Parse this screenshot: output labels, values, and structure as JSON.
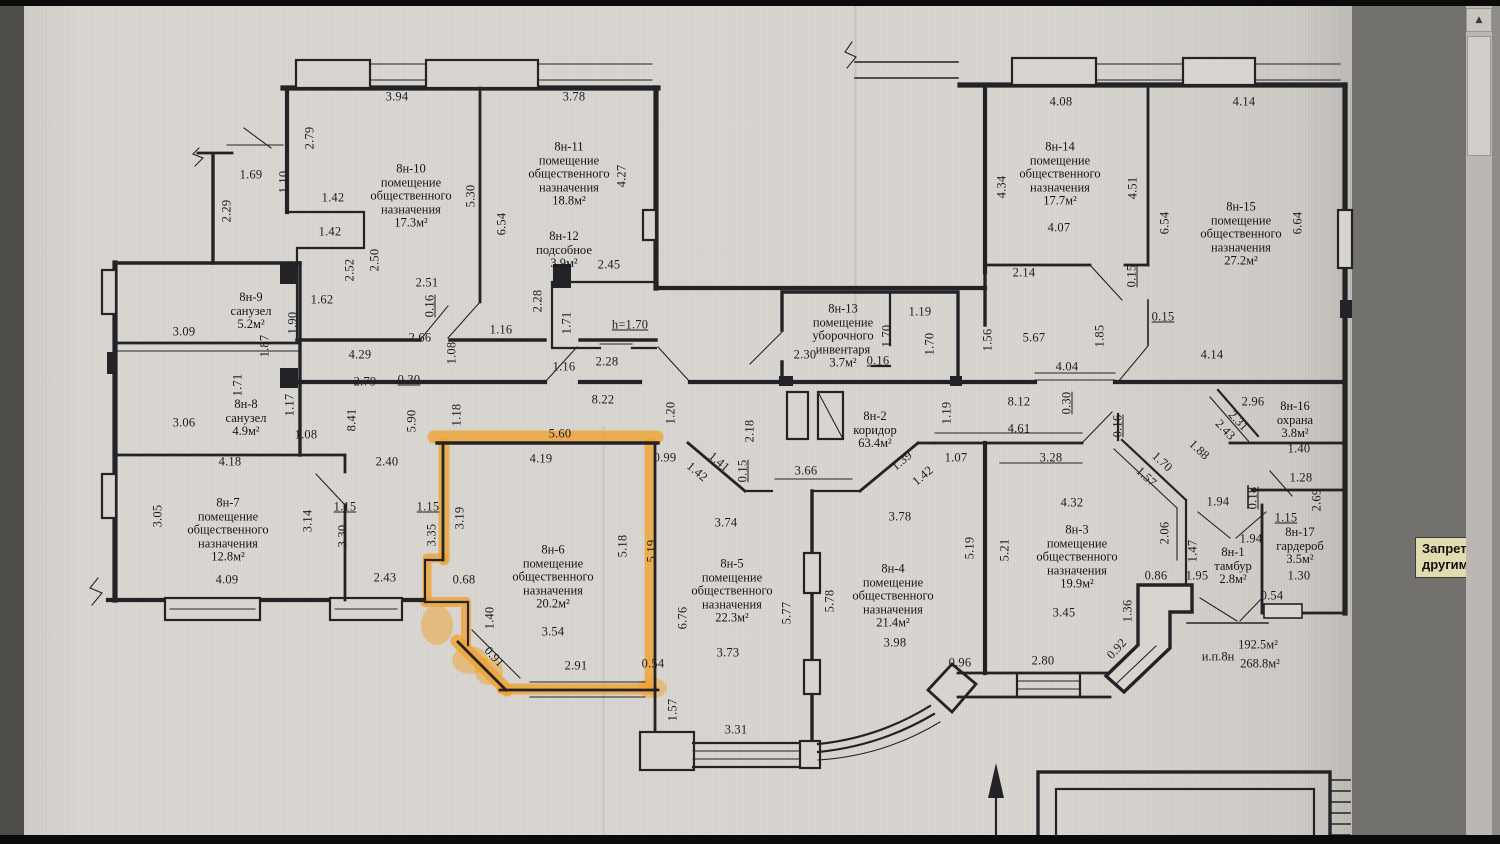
{
  "colors": {
    "ink": "#232327",
    "highlight": "#f0a22e",
    "paper": "#d8d5d0"
  },
  "viewer": {
    "tooltip": {
      "line1": "Запрет копиров",
      "line2": "другими пользо"
    },
    "scrollbar": {
      "up_arrow": "▲"
    }
  },
  "plan": {
    "summary": [
      {
        "t": "и.п.8н",
        "x": 1218,
        "y": 657
      },
      {
        "t": "192.5м²",
        "x": 1258,
        "y": 645
      },
      {
        "t": "268.8м²",
        "x": 1260,
        "y": 664
      }
    ],
    "rooms": [
      {
        "id": "8н-9",
        "x": 251,
        "y": 311,
        "lines": [
          "8н-9",
          "санузел",
          "5.2м²"
        ]
      },
      {
        "id": "8н-8",
        "x": 246,
        "y": 418,
        "lines": [
          "8н-8",
          "санузел",
          "4.9м²"
        ]
      },
      {
        "id": "8н-7",
        "x": 228,
        "y": 530,
        "lines": [
          "8н-7",
          "помещение",
          "общественного",
          "назначения",
          "12.8м²"
        ]
      },
      {
        "id": "8н-10",
        "x": 411,
        "y": 196,
        "lines": [
          "8н-10",
          "помещение",
          "общественного",
          "назначения",
          "17.3м²"
        ]
      },
      {
        "id": "8н-11",
        "x": 569,
        "y": 174,
        "lines": [
          "8н-11",
          "помещение",
          "общественного",
          "назначения",
          "18.8м²"
        ]
      },
      {
        "id": "8н-12",
        "x": 564,
        "y": 250,
        "lines": [
          "8н-12",
          "подсобное",
          "3.9м²"
        ]
      },
      {
        "id": "8н-13",
        "x": 843,
        "y": 336,
        "lines": [
          "8н-13",
          "помещение",
          "уборочного",
          "инвентаря",
          "3.7м²"
        ]
      },
      {
        "id": "8н-2",
        "x": 875,
        "y": 430,
        "lines": [
          "8н-2",
          "коридор",
          "63.4м²"
        ]
      },
      {
        "id": "8н-6",
        "x": 553,
        "y": 577,
        "highlighted": true,
        "lines": [
          "8н-6",
          "помещение",
          "общественного",
          "назначения",
          "20.2м²"
        ]
      },
      {
        "id": "8н-5",
        "x": 732,
        "y": 591,
        "lines": [
          "8н-5",
          "помещение",
          "общественного",
          "назначения",
          "22.3м²"
        ]
      },
      {
        "id": "8н-4",
        "x": 893,
        "y": 596,
        "lines": [
          "8н-4",
          "помещение",
          "общественного",
          "назначения",
          "21.4м²"
        ]
      },
      {
        "id": "8н-3",
        "x": 1077,
        "y": 557,
        "lines": [
          "8н-3",
          "помещение",
          "общественного",
          "назначения",
          "19.9м²"
        ]
      },
      {
        "id": "8н-14",
        "x": 1060,
        "y": 174,
        "lines": [
          "8н-14",
          "помещение",
          "общественного",
          "назначения",
          "17.7м²"
        ]
      },
      {
        "id": "8н-15",
        "x": 1241,
        "y": 234,
        "lines": [
          "8н-15",
          "помещение",
          "общественного",
          "назначения",
          "27.2м²"
        ]
      },
      {
        "id": "8н-16",
        "x": 1295,
        "y": 420,
        "lines": [
          "8н-16",
          "охрана",
          "3.8м²"
        ]
      },
      {
        "id": "8н-17",
        "x": 1300,
        "y": 546,
        "lines": [
          "8н-17",
          "гардероб",
          "3.5м²"
        ]
      },
      {
        "id": "8н-1",
        "x": 1233,
        "y": 566,
        "lines": [
          "8н-1",
          "тамбур",
          "2.8м²"
        ]
      }
    ],
    "dimensions": [
      {
        "t": "3.94",
        "x": 397,
        "y": 97
      },
      {
        "t": "3.78",
        "x": 574,
        "y": 97
      },
      {
        "t": "2.79",
        "x": 310,
        "y": 138,
        "r": -90
      },
      {
        "t": "1.69",
        "x": 251,
        "y": 175
      },
      {
        "t": "1.10",
        "x": 284,
        "y": 182,
        "r": -90
      },
      {
        "t": "2.29",
        "x": 227,
        "y": 211,
        "r": -90
      },
      {
        "t": "1.42",
        "x": 333,
        "y": 198
      },
      {
        "t": "1.42",
        "x": 330,
        "y": 232
      },
      {
        "t": "5.30",
        "x": 471,
        "y": 196,
        "r": -90
      },
      {
        "t": "6.54",
        "x": 502,
        "y": 224,
        "r": -90
      },
      {
        "t": "4.27",
        "x": 622,
        "y": 176,
        "r": -90
      },
      {
        "t": "2.52",
        "x": 350,
        "y": 270,
        "r": -90
      },
      {
        "t": "2.50",
        "x": 375,
        "y": 260,
        "r": -90
      },
      {
        "t": "2.51",
        "x": 427,
        "y": 283
      },
      {
        "t": "0.16",
        "x": 430,
        "y": 306,
        "r": -90,
        "u": 1
      },
      {
        "t": "1.62",
        "x": 322,
        "y": 300
      },
      {
        "t": "1.90",
        "x": 293,
        "y": 323,
        "r": -90
      },
      {
        "t": "1.87",
        "x": 265,
        "y": 346,
        "r": -90
      },
      {
        "t": "2.66",
        "x": 420,
        "y": 338
      },
      {
        "t": "1.16",
        "x": 501,
        "y": 330
      },
      {
        "t": "1.08",
        "x": 452,
        "y": 353,
        "r": -90
      },
      {
        "t": "4.29",
        "x": 360,
        "y": 355
      },
      {
        "t": "2.28",
        "x": 538,
        "y": 301,
        "r": -90
      },
      {
        "t": "1.71",
        "x": 567,
        "y": 323,
        "r": -90
      },
      {
        "t": "2.45",
        "x": 609,
        "y": 265
      },
      {
        "t": "h=1.70",
        "x": 630,
        "y": 325,
        "u": 1
      },
      {
        "t": "2.28",
        "x": 607,
        "y": 362
      },
      {
        "t": "1.16",
        "x": 564,
        "y": 367
      },
      {
        "t": "0.30",
        "x": 409,
        "y": 380,
        "u": 1
      },
      {
        "t": "2.79",
        "x": 365,
        "y": 382
      },
      {
        "t": "8.22",
        "x": 603,
        "y": 400
      },
      {
        "t": "3.09",
        "x": 184,
        "y": 332
      },
      {
        "t": "3.06",
        "x": 184,
        "y": 423
      },
      {
        "t": "1.71",
        "x": 238,
        "y": 385,
        "r": -90
      },
      {
        "t": "1.17",
        "x": 290,
        "y": 405,
        "r": -90
      },
      {
        "t": "1.08",
        "x": 306,
        "y": 435
      },
      {
        "t": "4.18",
        "x": 230,
        "y": 462
      },
      {
        "t": "2.40",
        "x": 387,
        "y": 462
      },
      {
        "t": "3.05",
        "x": 158,
        "y": 516,
        "r": -90
      },
      {
        "t": "3.14",
        "x": 308,
        "y": 521,
        "r": -90
      },
      {
        "t": "3.30",
        "x": 343,
        "y": 536,
        "r": -90
      },
      {
        "t": "1.15",
        "x": 345,
        "y": 507,
        "u": 1
      },
      {
        "t": "4.09",
        "x": 227,
        "y": 580
      },
      {
        "t": "2.43",
        "x": 385,
        "y": 578
      },
      {
        "t": "8.41",
        "x": 352,
        "y": 420,
        "r": -90
      },
      {
        "t": "5.90",
        "x": 412,
        "y": 421,
        "r": -90
      },
      {
        "t": "1.18",
        "x": 457,
        "y": 415,
        "r": -90
      },
      {
        "t": "5.60",
        "x": 560,
        "y": 434
      },
      {
        "t": "4.19",
        "x": 541,
        "y": 459
      },
      {
        "t": "1.20",
        "x": 671,
        "y": 413,
        "r": -90
      },
      {
        "t": "0.99",
        "x": 665,
        "y": 458
      },
      {
        "t": "3.19",
        "x": 460,
        "y": 518,
        "r": -90
      },
      {
        "t": "3.35",
        "x": 432,
        "y": 535,
        "r": -90
      },
      {
        "t": "1.15",
        "x": 428,
        "y": 507,
        "u": 1
      },
      {
        "t": "0.68",
        "x": 464,
        "y": 580
      },
      {
        "t": "1.40",
        "x": 490,
        "y": 618,
        "r": -90
      },
      {
        "t": "0.91",
        "x": 494,
        "y": 657,
        "r": 47
      },
      {
        "t": "3.54",
        "x": 553,
        "y": 632
      },
      {
        "t": "2.91",
        "x": 576,
        "y": 666
      },
      {
        "t": "5.18",
        "x": 623,
        "y": 546,
        "r": -90
      },
      {
        "t": "5.19",
        "x": 652,
        "y": 551,
        "r": -90
      },
      {
        "t": "0.54",
        "x": 653,
        "y": 664
      },
      {
        "t": "6.76",
        "x": 683,
        "y": 618,
        "r": -90
      },
      {
        "t": "2.30",
        "x": 805,
        "y": 355
      },
      {
        "t": "1.19",
        "x": 920,
        "y": 312
      },
      {
        "t": "1.70",
        "x": 887,
        "y": 336,
        "r": -90
      },
      {
        "t": "1.70",
        "x": 930,
        "y": 344,
        "r": -90
      },
      {
        "t": "0.16",
        "x": 878,
        "y": 361,
        "u": 1
      },
      {
        "t": "2.18",
        "x": 750,
        "y": 431,
        "r": -90
      },
      {
        "t": "1.42",
        "x": 697,
        "y": 472,
        "r": 40
      },
      {
        "t": "1.41",
        "x": 719,
        "y": 462,
        "r": 40
      },
      {
        "t": "0.15",
        "x": 743,
        "y": 471,
        "r": -90,
        "u": 1
      },
      {
        "t": "3.66",
        "x": 806,
        "y": 471
      },
      {
        "t": "1.39",
        "x": 902,
        "y": 461,
        "r": -40
      },
      {
        "t": "1.42",
        "x": 923,
        "y": 476,
        "r": -40
      },
      {
        "t": "1.07",
        "x": 956,
        "y": 458
      },
      {
        "t": "3.74",
        "x": 726,
        "y": 523
      },
      {
        "t": "3.78",
        "x": 900,
        "y": 517
      },
      {
        "t": "1.19",
        "x": 947,
        "y": 413,
        "r": -90
      },
      {
        "t": "8.12",
        "x": 1019,
        "y": 402
      },
      {
        "t": "4.61",
        "x": 1019,
        "y": 429
      },
      {
        "t": "0.30",
        "x": 1067,
        "y": 403,
        "r": -90,
        "u": 1
      },
      {
        "t": "4.04",
        "x": 1067,
        "y": 367
      },
      {
        "t": "5.67",
        "x": 1034,
        "y": 338
      },
      {
        "t": "1.85",
        "x": 1100,
        "y": 336,
        "r": -90
      },
      {
        "t": "1.56",
        "x": 988,
        "y": 340,
        "r": -90
      },
      {
        "t": "4.14",
        "x": 1212,
        "y": 355
      },
      {
        "t": "3.28",
        "x": 1051,
        "y": 458
      },
      {
        "t": "5.77",
        "x": 787,
        "y": 613,
        "r": -90
      },
      {
        "t": "5.78",
        "x": 830,
        "y": 601,
        "r": -90
      },
      {
        "t": "3.73",
        "x": 728,
        "y": 653
      },
      {
        "t": "3.98",
        "x": 895,
        "y": 643
      },
      {
        "t": "0.96",
        "x": 960,
        "y": 663
      },
      {
        "t": "1.57",
        "x": 673,
        "y": 710,
        "r": -90
      },
      {
        "t": "3.31",
        "x": 736,
        "y": 730
      },
      {
        "t": "2.80",
        "x": 1043,
        "y": 661
      },
      {
        "t": "5.19",
        "x": 970,
        "y": 548,
        "r": -90
      },
      {
        "t": "5.21",
        "x": 1005,
        "y": 550,
        "r": -90
      },
      {
        "t": "4.32",
        "x": 1072,
        "y": 503
      },
      {
        "t": "3.45",
        "x": 1064,
        "y": 613
      },
      {
        "t": "0.16",
        "x": 1118,
        "y": 426,
        "r": -90,
        "u": 1
      },
      {
        "t": "1.70",
        "x": 1162,
        "y": 462,
        "r": 43
      },
      {
        "t": "1.57",
        "x": 1146,
        "y": 477,
        "r": 43
      },
      {
        "t": "1.88",
        "x": 1199,
        "y": 450,
        "r": 43
      },
      {
        "t": "2.06",
        "x": 1165,
        "y": 533,
        "r": -90
      },
      {
        "t": "1.47",
        "x": 1193,
        "y": 551,
        "r": -90
      },
      {
        "t": "0.86",
        "x": 1156,
        "y": 576
      },
      {
        "t": "1.95",
        "x": 1197,
        "y": 576
      },
      {
        "t": "1.36",
        "x": 1128,
        "y": 611,
        "r": -90
      },
      {
        "t": "0.92",
        "x": 1117,
        "y": 649,
        "r": -48
      },
      {
        "t": "1.94",
        "x": 1218,
        "y": 502
      },
      {
        "t": "1.94",
        "x": 1251,
        "y": 539
      },
      {
        "t": "2.96",
        "x": 1253,
        "y": 402
      },
      {
        "t": "2.31",
        "x": 1238,
        "y": 421,
        "r": 47
      },
      {
        "t": "2.43",
        "x": 1225,
        "y": 430,
        "r": 47
      },
      {
        "t": "1.40",
        "x": 1299,
        "y": 449
      },
      {
        "t": "1.28",
        "x": 1301,
        "y": 478
      },
      {
        "t": "2.69",
        "x": 1317,
        "y": 500,
        "r": -90
      },
      {
        "t": "0.18",
        "x": 1253,
        "y": 498,
        "r": -90,
        "u": 1
      },
      {
        "t": "1.15",
        "x": 1286,
        "y": 518,
        "u": 1
      },
      {
        "t": "1.30",
        "x": 1299,
        "y": 576
      },
      {
        "t": "0.54",
        "x": 1272,
        "y": 596
      },
      {
        "t": "4.08",
        "x": 1061,
        "y": 102
      },
      {
        "t": "4.14",
        "x": 1244,
        "y": 102
      },
      {
        "t": "4.34",
        "x": 1002,
        "y": 187,
        "r": -90
      },
      {
        "t": "4.51",
        "x": 1133,
        "y": 188,
        "r": -90
      },
      {
        "t": "4.07",
        "x": 1059,
        "y": 228
      },
      {
        "t": "6.54",
        "x": 1165,
        "y": 223,
        "r": -90
      },
      {
        "t": "6.64",
        "x": 1298,
        "y": 223,
        "r": -90
      },
      {
        "t": "2.14",
        "x": 1024,
        "y": 273
      },
      {
        "t": "0.15",
        "x": 1132,
        "y": 276,
        "r": -90,
        "u": 1
      },
      {
        "t": "0.15",
        "x": 1163,
        "y": 317,
        "u": 1
      }
    ]
  }
}
